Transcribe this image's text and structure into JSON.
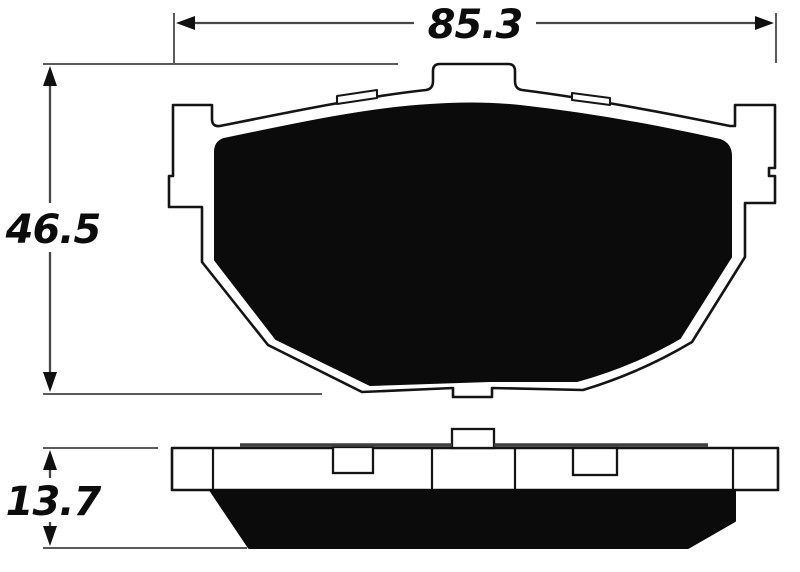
{
  "drawing": {
    "type": "technical-dimension-drawing",
    "subject": "disc-brake-pad",
    "dimensions": {
      "width_mm": "85.3",
      "height_mm": "46.5",
      "thickness_mm": "13.7"
    },
    "colors": {
      "background": "#ffffff",
      "outline": "#141414",
      "friction_fill": "#0b0b0b",
      "dimension_line": "#474747",
      "shim_line": "#3f3f3f"
    }
  }
}
